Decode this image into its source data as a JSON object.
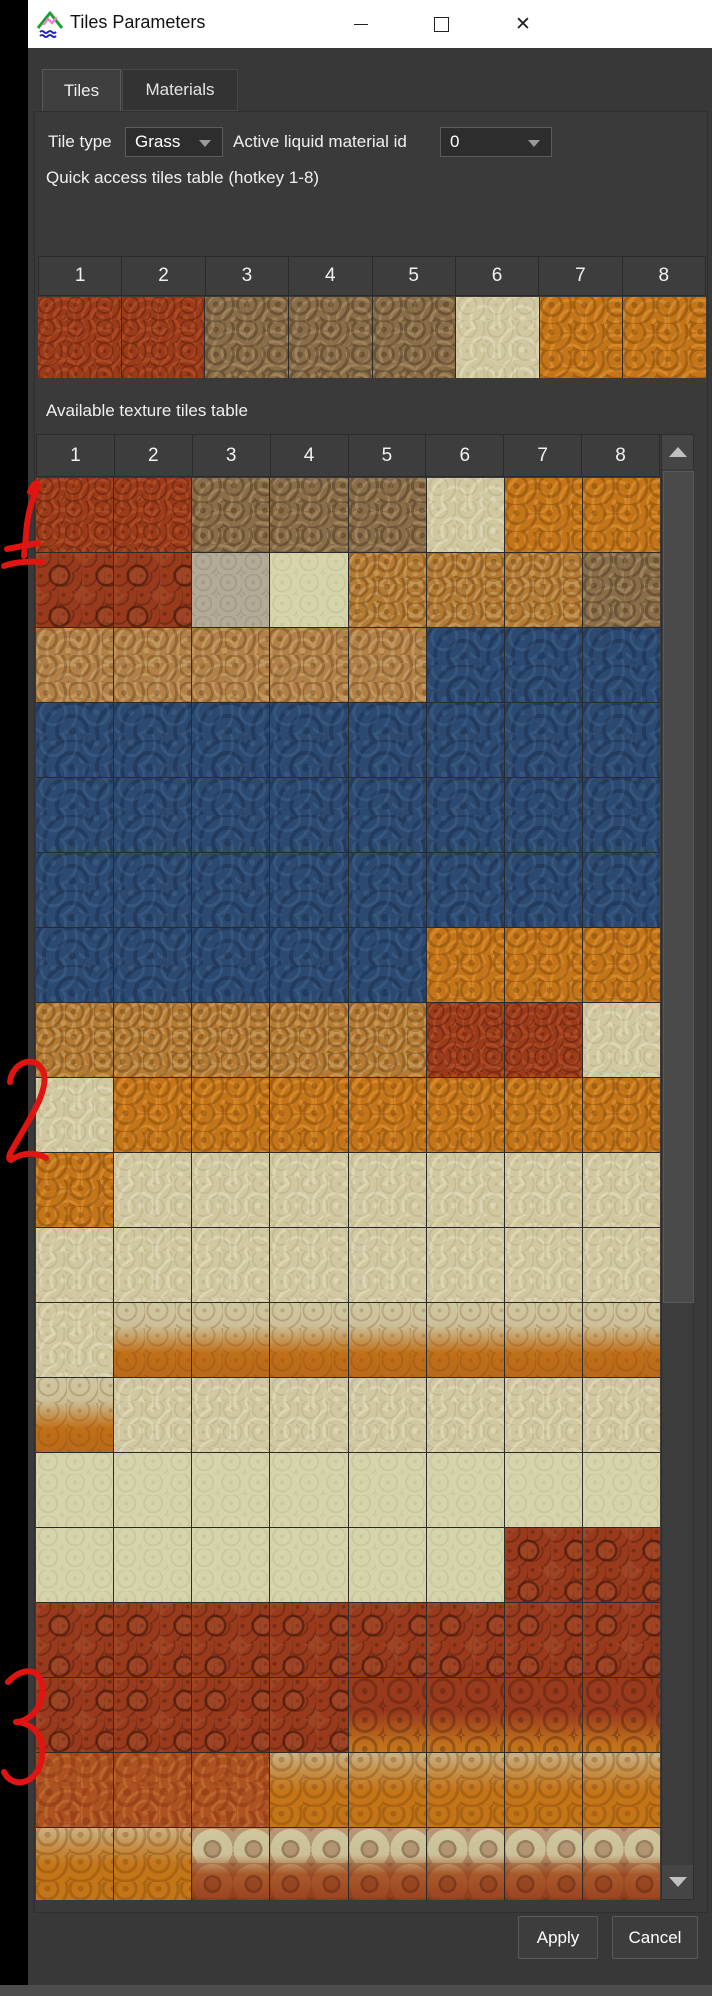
{
  "window": {
    "title": "Tiles Parameters",
    "controls": {
      "minimize": "minimize",
      "maximize": "maximize",
      "close": "✕"
    }
  },
  "tabs": [
    {
      "label": "Tiles",
      "active": true
    },
    {
      "label": "Materials",
      "active": false
    }
  ],
  "controls": {
    "tile_type_label": "Tile type",
    "tile_type_value": "Grass",
    "liquid_label": "Active liquid material id",
    "liquid_value": "0"
  },
  "quick_access": {
    "label": "Quick access tiles table (hotkey 1-8)",
    "headers": [
      "1",
      "2",
      "3",
      "4",
      "5",
      "6",
      "7",
      "8"
    ],
    "tiles": [
      "rust",
      "rust",
      "brown",
      "brown",
      "brown",
      "cream",
      "orange",
      "orange"
    ]
  },
  "available": {
    "label": "Available texture tiles table",
    "headers": [
      "1",
      "2",
      "3",
      "4",
      "5",
      "6",
      "7",
      "8"
    ],
    "rows": [
      [
        "rust",
        "rust",
        "brown",
        "brown",
        "brown",
        "cream",
        "orange",
        "orange"
      ],
      [
        "pebble",
        "pebble",
        "gray",
        "green",
        "ortan",
        "ortan",
        "ortan",
        "brown"
      ],
      [
        "tan",
        "tan",
        "tan",
        "tan",
        "tan",
        "blue",
        "blue",
        "blue"
      ],
      [
        "blue",
        "blue",
        "blue",
        "blue",
        "blue",
        "blue",
        "blue",
        "blue"
      ],
      [
        "blue",
        "blue",
        "blue",
        "blue",
        "blue",
        "blue",
        "blue",
        "blue"
      ],
      [
        "blue",
        "blue",
        "blue",
        "blue",
        "blue",
        "blue",
        "blue",
        "blue"
      ],
      [
        "blue",
        "blue",
        "blue",
        "blue",
        "blue",
        "orange",
        "orange",
        "orange"
      ],
      [
        "ortan",
        "ortan",
        "ortan",
        "ortan",
        "ortan",
        "rust",
        "rust",
        "cream"
      ],
      [
        "cream",
        "orange",
        "orange",
        "orange",
        "orange",
        "orange",
        "orange",
        "orange"
      ],
      [
        "orange",
        "cream",
        "cream",
        "cream",
        "cream",
        "cream",
        "cream",
        "cream"
      ],
      [
        "cream",
        "cream",
        "cream",
        "cream",
        "cream",
        "cream",
        "cream",
        "cream"
      ],
      [
        "cream",
        "cream2orange",
        "cream2orange",
        "cream2orange",
        "cream2orange",
        "cream2orange",
        "cream2orange",
        "cream2orange"
      ],
      [
        "cream2orange",
        "cream",
        "cream",
        "cream",
        "cream",
        "cream",
        "cream",
        "cream"
      ],
      [
        "green",
        "green",
        "green",
        "green",
        "green",
        "green",
        "green",
        "green"
      ],
      [
        "green",
        "green",
        "green",
        "green",
        "green",
        "green",
        "pebble",
        "pebble"
      ],
      [
        "pebble",
        "pebble",
        "pebble",
        "pebble",
        "pebble",
        "pebble",
        "pebble",
        "pebble"
      ],
      [
        "pebble",
        "pebble",
        "pebble",
        "pebble",
        "red2orange",
        "red2orange",
        "red2orange",
        "red2orange"
      ],
      [
        "orangered",
        "orangered",
        "orangered",
        "orangespeck",
        "orangespeck",
        "orangespeck",
        "orangespeck",
        "orangespeck"
      ],
      [
        "orangespeck",
        "orangespeck",
        "cream2red",
        "cream2red",
        "cream2red",
        "cream2red",
        "cream2red",
        "cream2red"
      ]
    ]
  },
  "buttons": {
    "apply": "Apply",
    "cancel": "Cancel"
  },
  "annotations": [
    {
      "text": "1"
    },
    {
      "text": "2"
    },
    {
      "text": "3"
    }
  ],
  "colors": {
    "titlebar_bg": "#ffffff",
    "panel_bg": "#383838",
    "annotation_red": "#e01410",
    "water_blue": "#2c4a71",
    "rust_red": "#9d3a1a",
    "grass_orange": "#c47518",
    "sand_cream": "#d1c8a1"
  }
}
